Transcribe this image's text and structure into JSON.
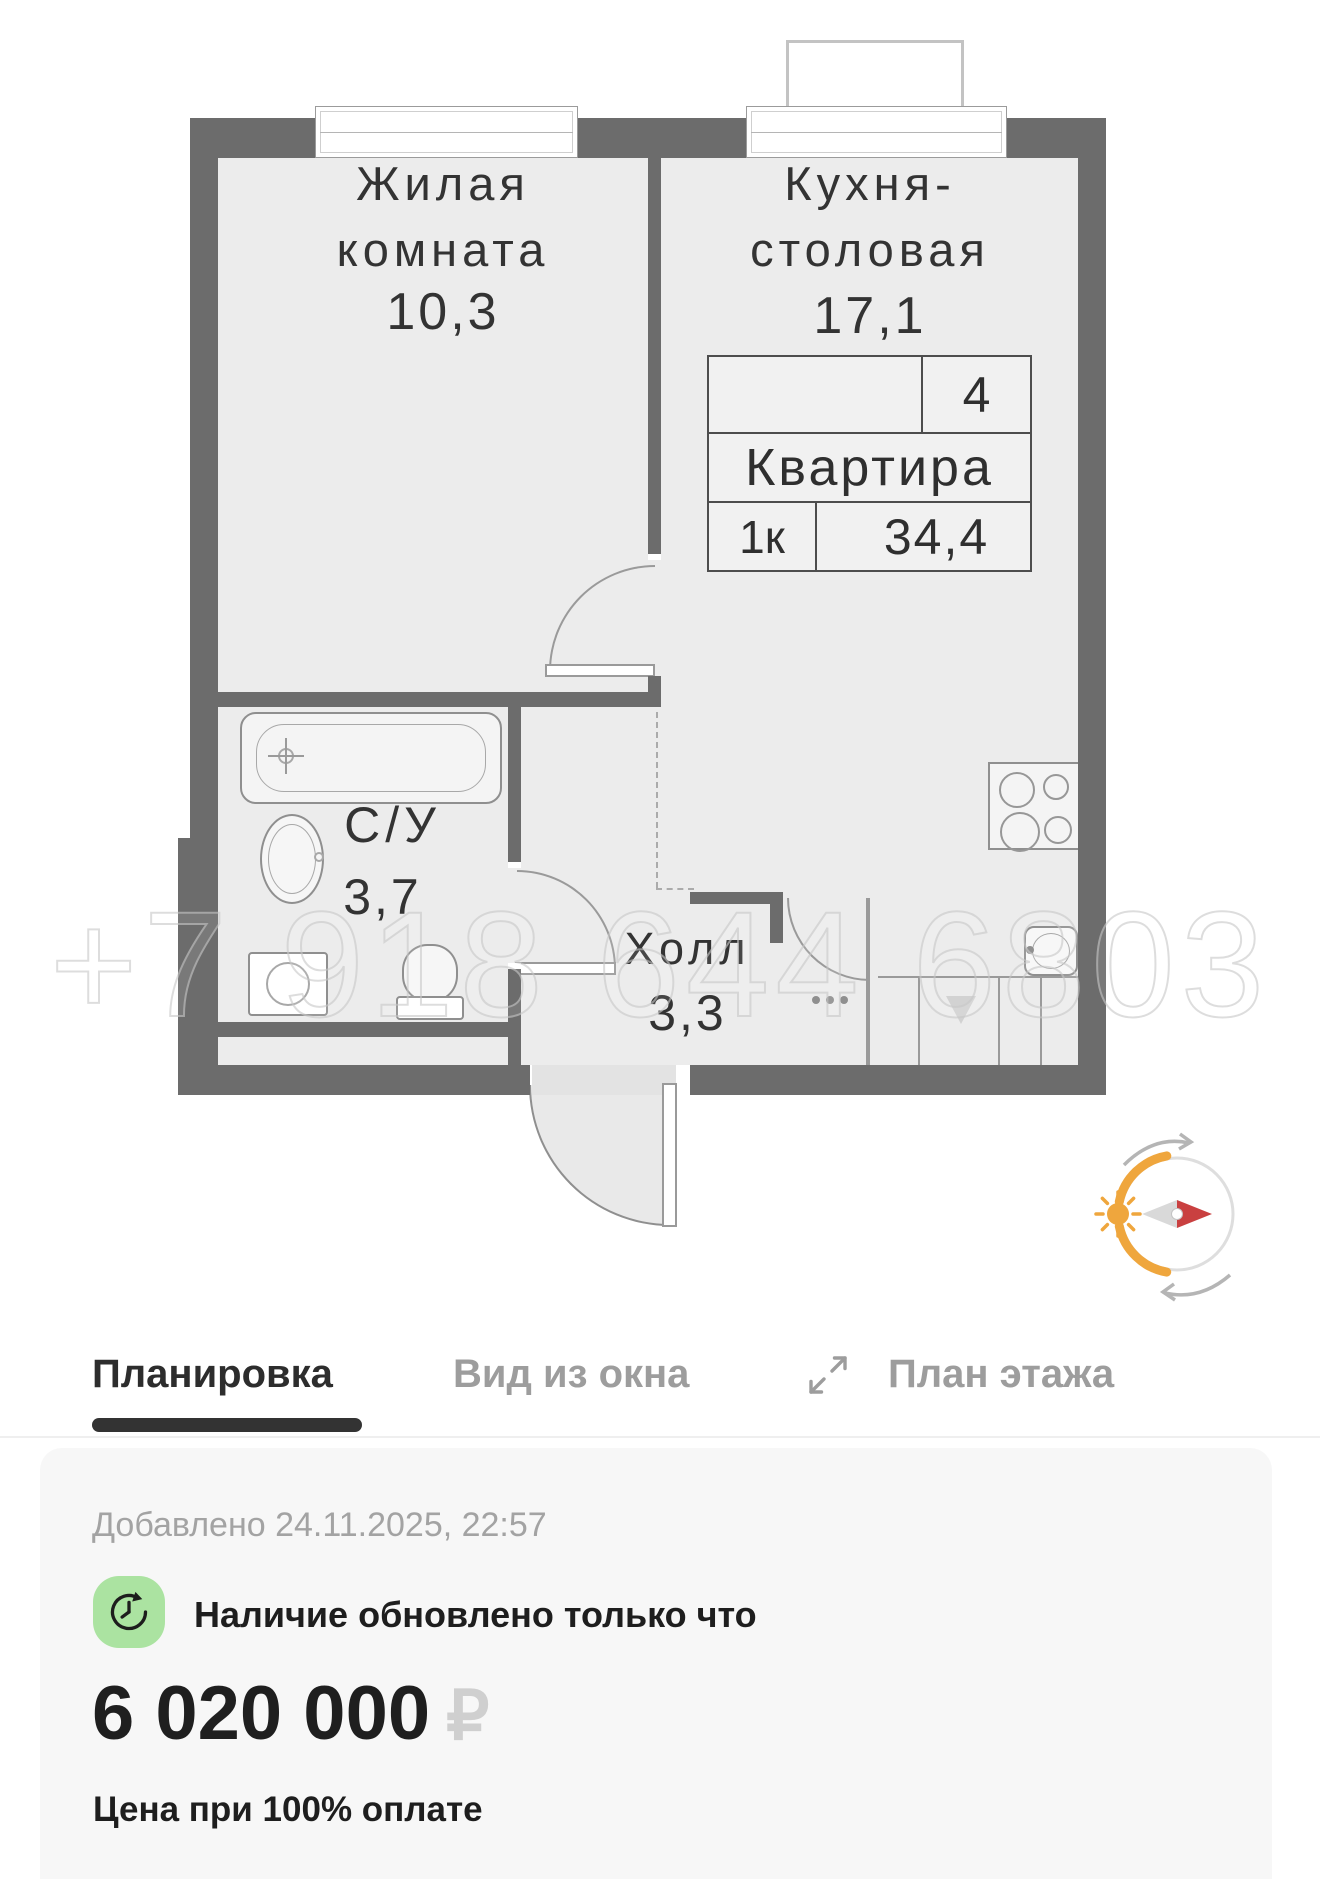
{
  "plan": {
    "watermark": "+7 918 644 6803",
    "rooms": {
      "living": {
        "line1": "Жилая",
        "line2": "комната",
        "area": "10,3"
      },
      "kitchen": {
        "line1": "Кухня-",
        "line2": "столовая",
        "area": "17,1"
      },
      "bathroom": {
        "label": "С/У",
        "area": "3,7"
      },
      "hall": {
        "label": "Холл",
        "area": "3,3"
      }
    },
    "info_table": {
      "floor": "4",
      "title": "Квартира",
      "rooms": "1к",
      "total_area": "34,4"
    }
  },
  "tabs": {
    "items": [
      {
        "label": "Планировка",
        "active": true
      },
      {
        "label": "Вид из окна",
        "active": false
      },
      {
        "label": "План этажа",
        "active": false
      }
    ]
  },
  "listing": {
    "added": "Добавлено 24.11.2025, 22:57",
    "availability": "Наличие обновлено только что",
    "price": "6 020 000",
    "currency": "₽",
    "price_note": "Цена при 100% оплате"
  },
  "colors": {
    "wall": "#6c6c6c",
    "floor": "#ececec",
    "accent_green": "#abe3a1",
    "compass_orange": "#efa63d",
    "compass_red": "#c94040",
    "active_tab": "#2d2d2d",
    "inactive_tab": "#9d9d9d"
  }
}
